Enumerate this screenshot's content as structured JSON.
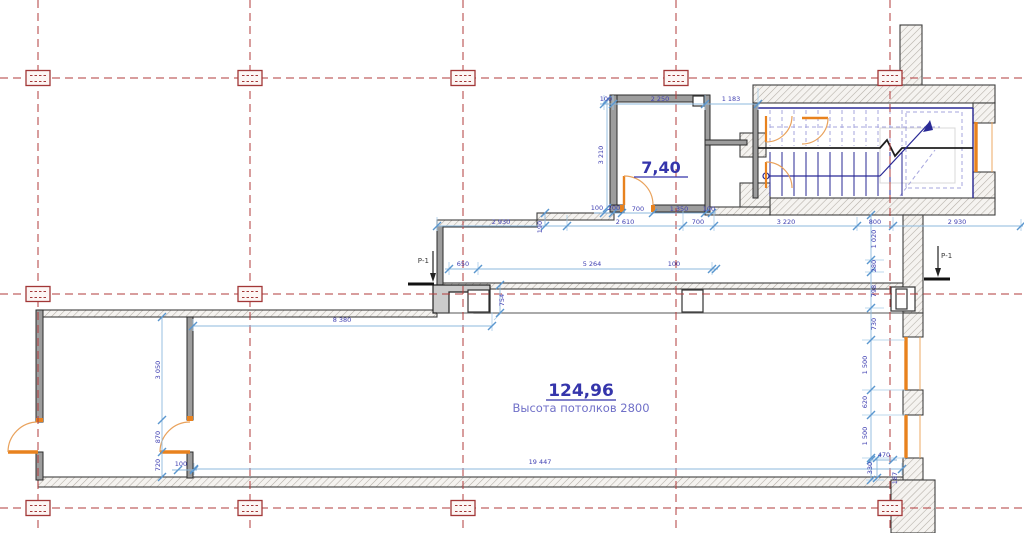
{
  "labels": {
    "room_small_area": "7,40",
    "room_large_area": "124,96",
    "room_large_note": "Высота потолков 2800",
    "section_marker_left": "Р-1",
    "section_marker_right": "Р-1"
  },
  "colors": {
    "grid_red": "#b23b3b",
    "wall_outline": "#3f3f3f",
    "hatch_gray": "#b3ada6",
    "partition_gray": "#9d9d9d",
    "dim_line_blue": "#8cb8dd",
    "dim_text_blue": "#4040b2",
    "door_window_orange": "#e8821e",
    "stair_navy": "#2a2a96",
    "stair_lavender": "#a6a6de",
    "label_navy": "#3535ab"
  },
  "grid": {
    "vertical_x": [
      38,
      250,
      463,
      676,
      890
    ],
    "horizontal_y": [
      78,
      294,
      508
    ],
    "markers": [
      [
        38,
        78
      ],
      [
        250,
        78
      ],
      [
        463,
        78
      ],
      [
        676,
        78
      ],
      [
        890,
        78
      ],
      [
        38,
        294
      ],
      [
        250,
        294
      ],
      [
        38,
        508
      ],
      [
        250,
        508
      ],
      [
        463,
        508
      ],
      [
        890,
        508
      ]
    ]
  },
  "dim_labels": [
    {
      "t": "100",
      "x": 606,
      "y": 101
    },
    {
      "t": "2 250",
      "x": 660,
      "y": 101
    },
    {
      "t": "1 183",
      "x": 731,
      "y": 101
    },
    {
      "t": "3 210",
      "x": 603,
      "y": 155,
      "r": 1
    },
    {
      "t": "100",
      "x": 597,
      "y": 210
    },
    {
      "t": "200",
      "x": 614,
      "y": 210
    },
    {
      "t": "700",
      "x": 638,
      "y": 211
    },
    {
      "t": "1 350",
      "x": 679,
      "y": 211
    },
    {
      "t": "100",
      "x": 709,
      "y": 211
    },
    {
      "t": "2 930",
      "x": 501,
      "y": 224
    },
    {
      "t": "2 610",
      "x": 625,
      "y": 224
    },
    {
      "t": "700",
      "x": 698,
      "y": 224
    },
    {
      "t": "3 220",
      "x": 786,
      "y": 224
    },
    {
      "t": "800",
      "x": 875,
      "y": 224
    },
    {
      "t": "2 930",
      "x": 957,
      "y": 224
    },
    {
      "t": "190",
      "x": 542,
      "y": 227,
      "r": 1
    },
    {
      "t": "650",
      "x": 463,
      "y": 266
    },
    {
      "t": "5 264",
      "x": 592,
      "y": 266
    },
    {
      "t": "100",
      "x": 674,
      "y": 266
    },
    {
      "t": "754",
      "x": 504,
      "y": 300,
      "r": 1
    },
    {
      "t": "1 020",
      "x": 876,
      "y": 239,
      "r": 1
    },
    {
      "t": "280",
      "x": 876,
      "y": 266,
      "r": 1
    },
    {
      "t": "798",
      "x": 876,
      "y": 291,
      "r": 1
    },
    {
      "t": "730",
      "x": 876,
      "y": 324,
      "r": 1
    },
    {
      "t": "1 500",
      "x": 867,
      "y": 365,
      "r": 1
    },
    {
      "t": "620",
      "x": 867,
      "y": 402,
      "r": 1
    },
    {
      "t": "1 500",
      "x": 867,
      "y": 436,
      "r": 1
    },
    {
      "t": "470",
      "x": 884,
      "y": 457
    },
    {
      "t": "330",
      "x": 872,
      "y": 468,
      "r": 1
    },
    {
      "t": "187",
      "x": 897,
      "y": 478,
      "r": 1
    },
    {
      "t": "8 380",
      "x": 342,
      "y": 322
    },
    {
      "t": "3 050",
      "x": 160,
      "y": 370,
      "r": 1
    },
    {
      "t": "870",
      "x": 160,
      "y": 437,
      "r": 1
    },
    {
      "t": "720",
      "x": 160,
      "y": 465,
      "r": 1
    },
    {
      "t": "100",
      "x": 181,
      "y": 466
    },
    {
      "t": "19 447",
      "x": 540,
      "y": 464
    }
  ],
  "dim_chains": [
    {
      "o": "h",
      "p": 104,
      "a": 600,
      "b": 760,
      "ticks": [
        604,
        613,
        705,
        758
      ]
    },
    {
      "o": "h",
      "p": 213,
      "a": 594,
      "b": 716,
      "ticks": [
        604,
        613,
        622,
        653,
        705,
        712
      ]
    },
    {
      "o": "h",
      "p": 226,
      "a": 437,
      "b": 1023,
      "ticks": [
        437,
        567,
        683,
        714,
        857,
        893,
        1021
      ]
    },
    {
      "o": "h",
      "p": 269,
      "a": 445,
      "b": 718,
      "ticks": [
        449,
        478,
        712,
        716
      ]
    },
    {
      "o": "h",
      "p": 326,
      "a": 193,
      "b": 492,
      "ticks": [
        193,
        492
      ]
    },
    {
      "o": "h",
      "p": 469,
      "a": 194,
      "b": 902,
      "ticks": [
        194,
        902
      ]
    },
    {
      "o": "h",
      "p": 470,
      "a": 172,
      "b": 197,
      "ticks": [
        178,
        194
      ]
    },
    {
      "o": "h",
      "p": 460,
      "a": 868,
      "b": 897,
      "ticks": [
        871,
        893
      ]
    },
    {
      "o": "v",
      "p": 607,
      "a": 100,
      "b": 208,
      "ticks": [
        100,
        208
      ]
    },
    {
      "o": "v",
      "p": 871,
      "a": 215,
      "b": 480,
      "ticks": [
        215,
        260,
        272,
        308,
        340,
        390,
        415,
        458,
        480
      ]
    },
    {
      "o": "v",
      "p": 162,
      "a": 317,
      "b": 477,
      "ticks": [
        317,
        420,
        452,
        477
      ]
    },
    {
      "o": "v",
      "p": 500,
      "a": 285,
      "b": 313,
      "ticks": [
        285,
        313
      ]
    },
    {
      "o": "v",
      "p": 545,
      "a": 213,
      "b": 226,
      "ticks": [
        213,
        226
      ]
    },
    {
      "o": "v",
      "p": 877,
      "a": 458,
      "b": 478,
      "ticks": [
        458,
        478
      ]
    }
  ],
  "dim_ext": [
    [
      604,
      95,
      604,
      110
    ],
    [
      613,
      95,
      613,
      110
    ],
    [
      705,
      95,
      705,
      110
    ],
    [
      758,
      88,
      758,
      110
    ],
    [
      437,
      217,
      437,
      231
    ],
    [
      567,
      215,
      567,
      231
    ],
    [
      683,
      210,
      683,
      231
    ],
    [
      714,
      210,
      714,
      231
    ],
    [
      857,
      217,
      857,
      231
    ],
    [
      893,
      217,
      893,
      231
    ],
    [
      1021,
      219,
      1021,
      231
    ],
    [
      449,
      262,
      449,
      275
    ],
    [
      478,
      262,
      478,
      275
    ],
    [
      712,
      262,
      712,
      275
    ],
    [
      193,
      319,
      193,
      331
    ],
    [
      492,
      312,
      492,
      331
    ],
    [
      494,
      320,
      502,
      312
    ],
    [
      194,
      463,
      194,
      475
    ],
    [
      902,
      463,
      902,
      475
    ],
    [
      865,
      260,
      884,
      260
    ],
    [
      865,
      272,
      884,
      272
    ],
    [
      865,
      308,
      884,
      308
    ],
    [
      862,
      340,
      905,
      340
    ],
    [
      862,
      390,
      905,
      390
    ],
    [
      862,
      415,
      905,
      415
    ],
    [
      862,
      458,
      905,
      458
    ],
    [
      866,
      480,
      884,
      480
    ]
  ]
}
